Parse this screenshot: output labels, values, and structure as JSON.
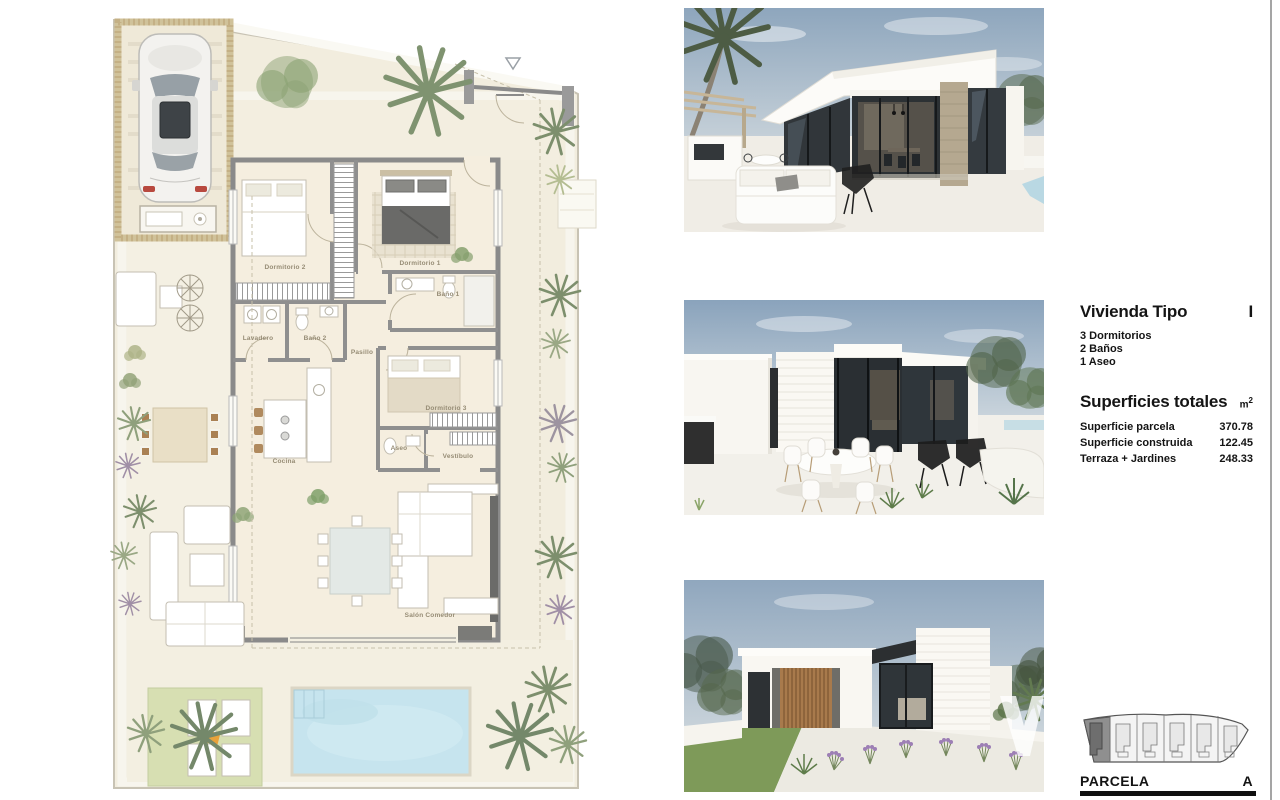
{
  "document": {
    "background": "#ffffff",
    "divider_color": "#a5a5a5"
  },
  "floor_plan": {
    "description": "Planta de vivienda con parcela, piscina, jardin y aparcamiento",
    "rooms": [
      {
        "label": "Dormitorio 2"
      },
      {
        "label": "Dormitorio 1"
      },
      {
        "label": "Baño 1"
      },
      {
        "label": "Lavadero"
      },
      {
        "label": "Baño 2"
      },
      {
        "label": "Pasillo"
      },
      {
        "label": "Dormitorio 3"
      },
      {
        "label": "Aseo"
      },
      {
        "label": "Cocina"
      },
      {
        "label": "Vestíbulo"
      },
      {
        "label": "Salón Comedor"
      }
    ],
    "colors": {
      "floor": "#f5eedf",
      "terrain": "#f2edde",
      "wall": "#8a8a8a",
      "pool": "#c6e4ee",
      "lawn": "#d7dfb2",
      "palm": "#7d8f6d",
      "carport": "#d0c29a"
    }
  },
  "renders": [
    {
      "description": "Render exterior: fachada principal con terraza, sofá blanco y cristaleras"
    },
    {
      "description": "Render exterior: terraza cubierta con mesa redonda de comedor"
    },
    {
      "description": "Render exterior: vista lateral con celosía de madera y jardín"
    }
  ],
  "info_panel": {
    "title": "Vivienda Tipo",
    "type_value": "I",
    "features": [
      {
        "text": "3 Dormitorios"
      },
      {
        "text": "2 Baños"
      },
      {
        "text": "1 Aseo"
      }
    ],
    "areas_heading": "Superficies totales",
    "unit": "m",
    "unit_exponent": "2",
    "areas": [
      {
        "label": "Superficie parcela",
        "value": "370.78"
      },
      {
        "label": "Superficie construida",
        "value": "122.45"
      },
      {
        "label": "Terraza + Jardines",
        "value": "248.33"
      }
    ],
    "parcel": {
      "label": "PARCELA",
      "value": "A"
    }
  }
}
